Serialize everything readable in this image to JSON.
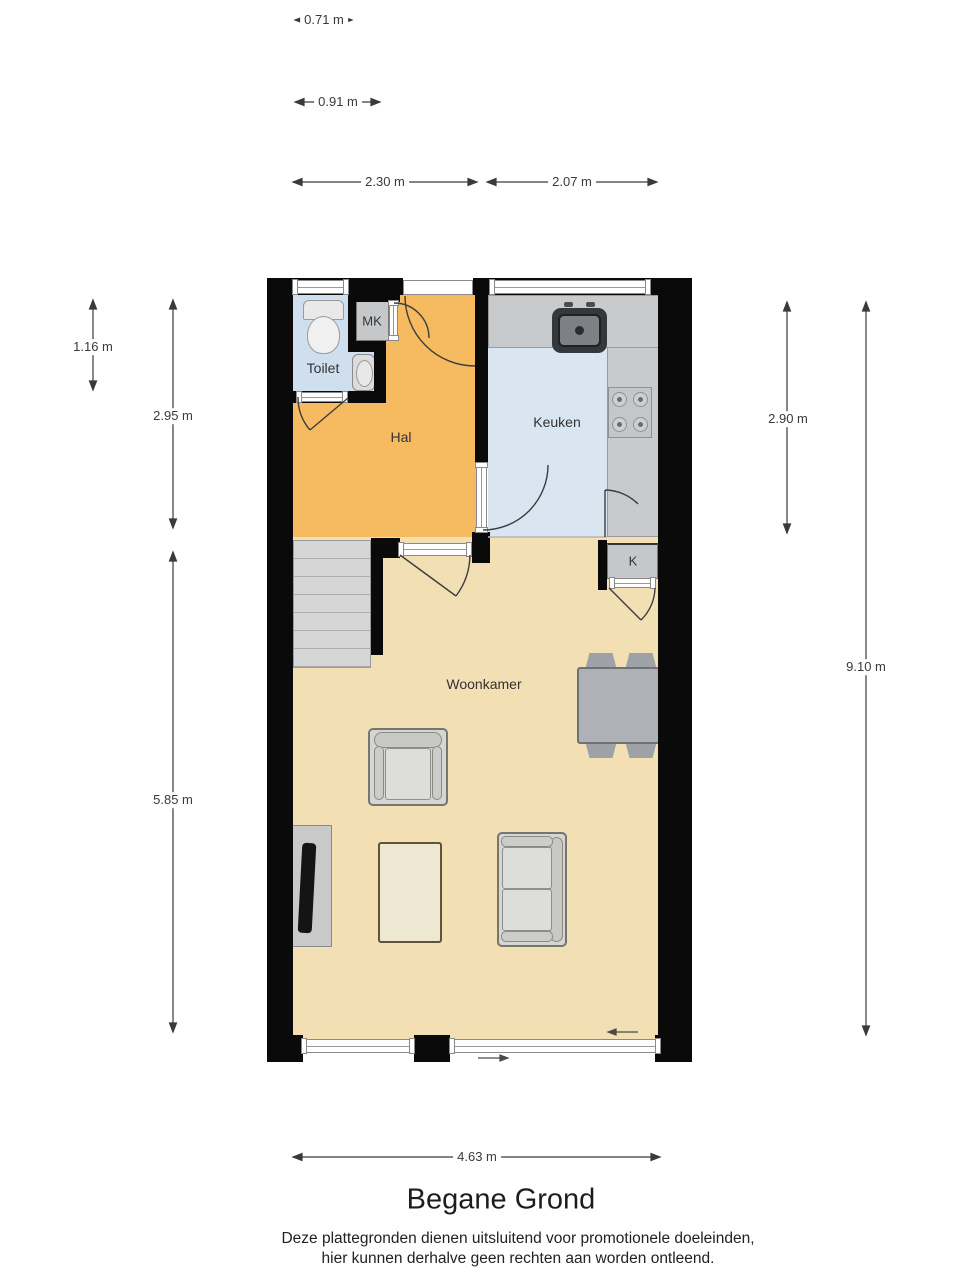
{
  "plan": {
    "title": "Begane Grond",
    "disclaimer1": "Deze plattegronden dienen uitsluitend voor promotionele doeleinden,",
    "disclaimer2": "hier kunnen derhalve geen rechten aan worden ontleend.",
    "rooms": {
      "hal": "Hal",
      "toilet": "Toilet",
      "keuken": "Keuken",
      "woonkamer": "Woonkamer",
      "mk": "MK",
      "k": "K"
    },
    "dims": {
      "d071": "0.71 m",
      "d091": "0.91 m",
      "d230": "2.30 m",
      "d207": "2.07 m",
      "d116": "1.16 m",
      "d295": "2.95 m",
      "d585": "5.85 m",
      "d290": "2.90 m",
      "d910": "9.10 m",
      "d463": "4.63 m"
    },
    "colors": {
      "wall": "#0a0a0a",
      "hal": "#F6BA61",
      "woonkamer": "#F2DFB4",
      "keuken": "#D9E5F1",
      "toilet": "#D0DFEE",
      "counter": "#C9CACB",
      "stairs": "#D6D6D6",
      "closet": "#C6C7C8"
    }
  }
}
